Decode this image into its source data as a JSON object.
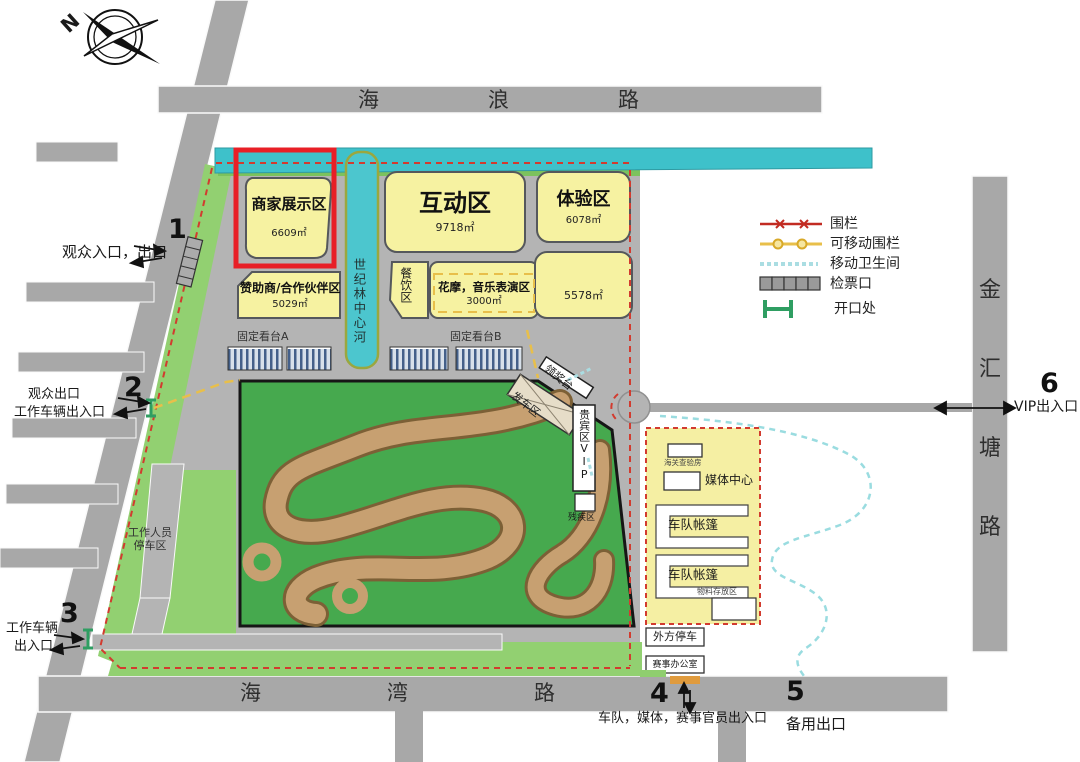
{
  "compass": {
    "label": "N"
  },
  "roads": {
    "top": {
      "name": "海浪路",
      "chars": [
        "海",
        "浪",
        "路"
      ]
    },
    "bottom": {
      "name": "海湾路",
      "chars": [
        "海",
        "湾",
        "路"
      ]
    },
    "right": {
      "name": "金汇塘路",
      "chars": [
        "金",
        "汇",
        "塘",
        "路"
      ]
    }
  },
  "zones": [
    {
      "name": "商家展示区",
      "area": "6609㎡",
      "highlighted": true
    },
    {
      "name": "互动区",
      "area": "9718㎡"
    },
    {
      "name": "体验区",
      "area": "6078㎡"
    },
    {
      "name": "赞助商/合作伙伴区",
      "area": "5029㎡"
    },
    {
      "name": "餐饮区",
      "area": ""
    },
    {
      "name": "花摩，音乐表演区",
      "area": "3000㎡"
    },
    {
      "name": "",
      "area": "5578㎡"
    }
  ],
  "water": {
    "canal": "世纪林中心河"
  },
  "stands": {
    "a": "固定看台A",
    "b": "固定看台B"
  },
  "track_labels": {
    "podium": "领奖台",
    "start_zone": "发车区",
    "vip": "贵宾区VIP",
    "disabled": "残疾区"
  },
  "paddock": {
    "customs": "海关查验房",
    "media_center": "媒体中心",
    "team_tent_1": "车队帐篷",
    "team_tent_2": "车队帐篷",
    "material_storage": "物料存放区",
    "foreign_parking": "外方停车",
    "event_office": "赛事办公室"
  },
  "parking": {
    "staff_line1": "工作人员",
    "staff_line2": "停车区"
  },
  "entrances": [
    {
      "num": "1",
      "label": "观众入口，出口"
    },
    {
      "num": "2",
      "label1": "观众出口",
      "label2": "工作车辆出入口"
    },
    {
      "num": "3",
      "label1": "工作车辆",
      "label2": "出入口"
    },
    {
      "num": "4",
      "label": "车队，媒体，赛事官员出入口"
    },
    {
      "num": "5",
      "label": "备用出口"
    },
    {
      "num": "6",
      "label": "VIP出入口"
    }
  ],
  "legend": {
    "items": [
      {
        "label": "围栏"
      },
      {
        "label": "可移动围栏"
      },
      {
        "label": "移动卫生间"
      },
      {
        "label": "检票口"
      },
      {
        "label": "开口处"
      }
    ]
  },
  "colors": {
    "fence_red": "#d23b2f",
    "fence_movable": "#e8bf4a",
    "toilet_cyan": "#aadde2",
    "opening_green": "#2f9e62",
    "highlight_red": "#e81f26",
    "zone_yellow": "#f6f2a1",
    "water_cyan": "#3ec1ca",
    "grass_green": "#92d071",
    "field_green": "#46a94e",
    "track_tan": "#c7a071",
    "road_gray": "#a8a8a8"
  }
}
